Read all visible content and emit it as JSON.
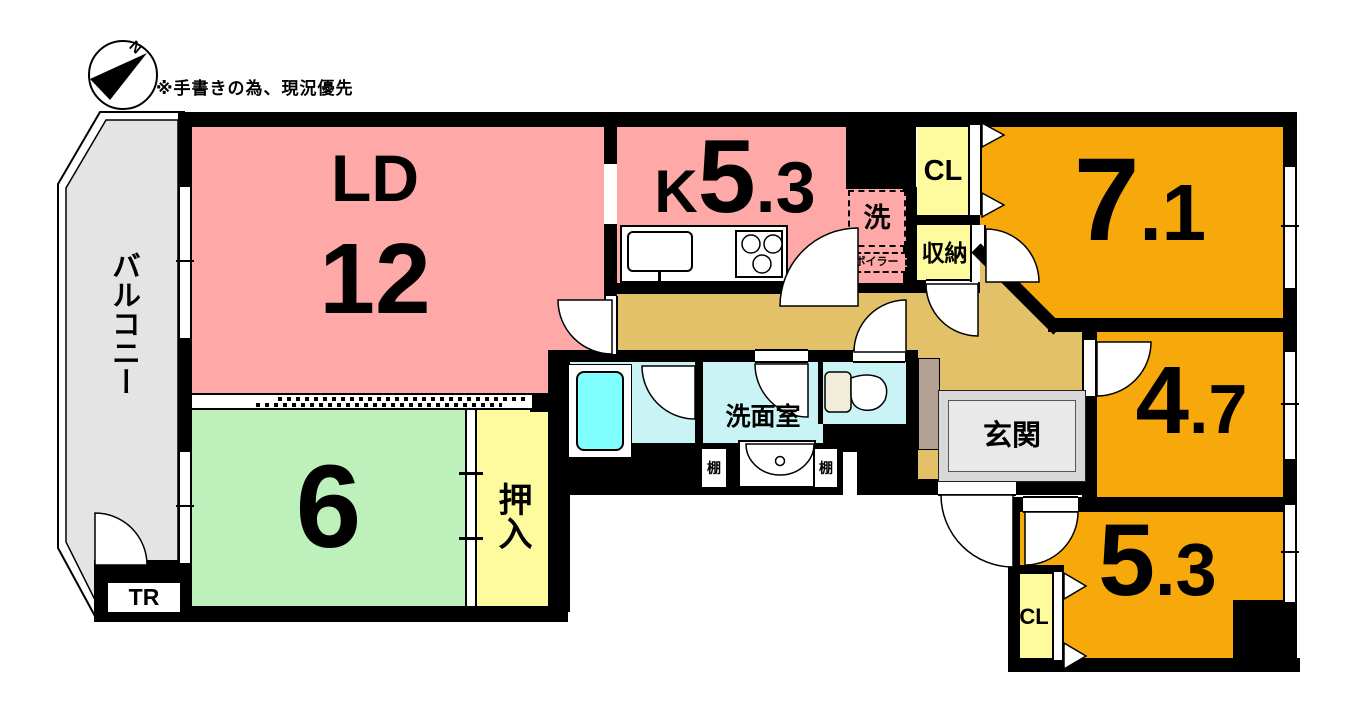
{
  "note": "※手書きの為、現況優先",
  "compass": {
    "label": "N"
  },
  "rooms": {
    "balcony": {
      "label": "バルコニー"
    },
    "ld": {
      "name": "LD",
      "size": "12"
    },
    "kitchen": {
      "name": "K",
      "size_big": "5",
      "size_small": ".3"
    },
    "room71": {
      "size_big": "7",
      "size_small": ".1"
    },
    "room47": {
      "size_big": "4",
      "size_small": ".7"
    },
    "room53": {
      "size_big": "5",
      "size_small": ".3"
    },
    "room6": {
      "size": "6"
    },
    "washroom": {
      "label": "洗面室"
    },
    "genkan": {
      "label": "玄関"
    }
  },
  "fixtures": {
    "laundry": "洗",
    "boiler": "ボイラー",
    "closet_top": "CL",
    "storage": "収納",
    "closet_bottom": "CL",
    "oshiire": "押入",
    "shelf_left": "棚",
    "shelf_right": "棚",
    "trunk_room": "TR"
  },
  "colors": {
    "wall": "#000000",
    "ld_kitchen_floor": "#FFA8A8",
    "western_room_floor": "#F7A80B",
    "japanese_room_floor": "#BDF0BA",
    "closet_floor": "#FEFB9E",
    "hallway_floor": "#E2C169",
    "wet_room_floor": "#C9F3F5",
    "bathtub": "#80FFFF",
    "balcony_floor": "#E4E4E4",
    "entrance_floor": "#D8D8D8",
    "shoe_cabinet": "#B3A294"
  }
}
